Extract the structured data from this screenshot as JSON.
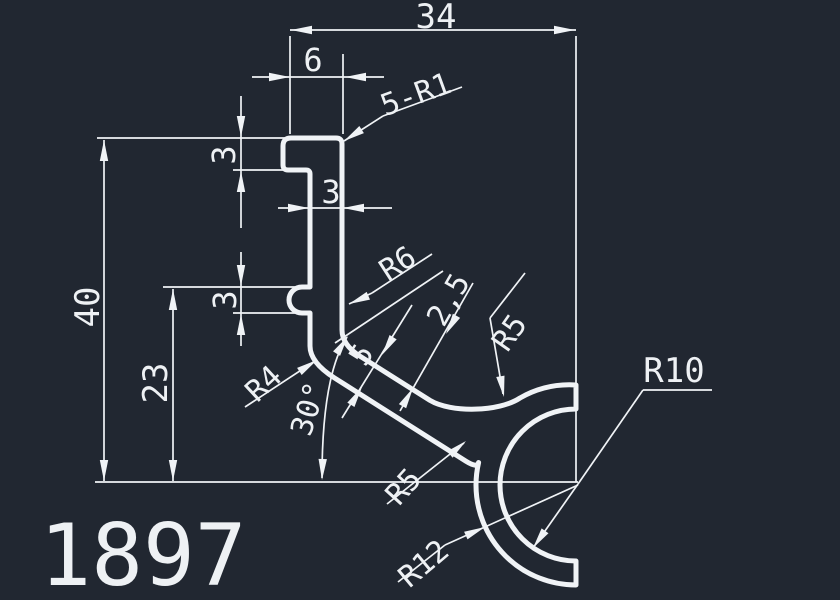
{
  "meta": {
    "type": "cad-technical-drawing",
    "part_number": "1897",
    "units_hint": "mm"
  },
  "colors": {
    "background": "#212731",
    "line": "#f0f3f6"
  },
  "dimensions_list": [
    {
      "label": "34",
      "kind": "linear-horizontal"
    },
    {
      "label": "6",
      "kind": "linear-horizontal"
    },
    {
      "label": "5-R1",
      "kind": "leader-radius-count"
    },
    {
      "label": "3",
      "kind": "linear-vertical-hook-top"
    },
    {
      "label": "3",
      "kind": "linear-wall-thickness"
    },
    {
      "label": "3",
      "kind": "linear-vertical-hook-lower"
    },
    {
      "label": "40",
      "kind": "linear-vertical"
    },
    {
      "label": "23",
      "kind": "linear-vertical"
    },
    {
      "label": "R6",
      "kind": "radius"
    },
    {
      "label": "2,5",
      "kind": "linear-thickness"
    },
    {
      "label": "R5",
      "kind": "radius-upper"
    },
    {
      "label": "R4",
      "kind": "radius"
    },
    {
      "label": "30°",
      "kind": "angular"
    },
    {
      "label": "5",
      "kind": "linear-thickness"
    },
    {
      "label": "R5",
      "kind": "radius-lower"
    },
    {
      "label": "R12",
      "kind": "radius"
    },
    {
      "label": "R10",
      "kind": "radius"
    }
  ],
  "drawing": {
    "width": 840,
    "height": 600,
    "profile_stroke_width": 5,
    "thin_stroke_width": 1.7,
    "profile_path": "M 291,138 L 336,138 Q 342,138 342,144 L 342,330 Q 342,344.8 360,356.2 L 430,400.4 C 451,413 499,412 520,398 A 100,100 0 0 1 576,385 L 576,409 A 76,76 0 0 0 500,485 A 76,76 0 0 0 576,561 L 576,585 A 100,100 0 0 1 476,485 A 100,100 0 0 1 478.6,462.5 Q 477.3,468.3 466,461.3 L 334.3,377.8 Q 310,362.4 310,346 L 310,313 L 302,313 A 13,13 0 0 1 302,287 L 310,287 L 310,174 Q 310,170 306,170 L 288,170 Q 283,170 283,165 L 283,146 Q 283,138 291,138 Z",
    "thin_lines": [
      [
        290,
        36,
        290,
        134
      ],
      [
        576,
        36,
        576,
        482
      ],
      [
        290,
        30,
        576,
        30
      ],
      [
        252,
        77,
        384,
        77
      ],
      [
        343,
        54,
        343,
        134
      ],
      [
        97,
        138,
        285,
        138
      ],
      [
        233,
        170,
        287,
        170
      ],
      [
        241,
        96,
        241,
        228
      ],
      [
        278,
        208,
        392,
        208
      ],
      [
        163,
        287,
        300,
        287
      ],
      [
        233,
        313,
        300,
        313
      ],
      [
        241,
        252,
        241,
        346
      ],
      [
        104,
        140,
        104,
        481
      ],
      [
        173,
        289,
        173,
        481
      ],
      [
        95,
        482,
        578,
        482
      ],
      [
        349,
        304,
        372,
        293
      ],
      [
        372,
        293,
        432,
        254
      ],
      [
        473,
        283,
        400,
        411
      ],
      [
        412,
        305,
        342,
        418
      ],
      [
        335,
        343,
        443,
        271
      ],
      [
        525,
        273,
        490,
        318
      ],
      [
        490,
        318,
        503,
        394
      ],
      [
        245,
        407,
        315,
        361
      ],
      [
        387,
        504,
        464,
        443
      ],
      [
        398,
        582,
        445,
        545
      ],
      [
        445,
        545,
        578,
        485
      ],
      [
        643,
        390,
        712,
        390
      ],
      [
        643,
        390,
        578,
        484
      ],
      [
        578,
        484,
        533,
        548
      ],
      [
        344,
        141,
        383,
        116
      ],
      [
        383,
        116,
        462,
        87
      ]
    ],
    "thin_paths": [
      "M 322,478 Q 322,376 347,337"
    ],
    "arrows": [
      [
        291,
        30,
        180
      ],
      [
        575,
        30,
        0
      ],
      [
        290,
        77,
        0
      ],
      [
        345,
        77,
        180
      ],
      [
        241,
        137,
        90
      ],
      [
        241,
        171,
        270
      ],
      [
        309,
        208,
        0
      ],
      [
        343,
        208,
        180
      ],
      [
        241,
        286,
        90
      ],
      [
        241,
        314,
        270
      ],
      [
        104,
        140,
        270
      ],
      [
        104,
        481,
        90
      ],
      [
        173,
        289,
        270
      ],
      [
        173,
        481,
        90
      ],
      [
        349,
        304,
        157
      ],
      [
        446,
        334,
        120
      ],
      [
        413,
        388,
        300
      ],
      [
        382,
        355,
        122
      ],
      [
        362,
        387,
        302
      ],
      [
        504,
        397,
        80
      ],
      [
        317,
        360,
        -33
      ],
      [
        322,
        480,
        92
      ],
      [
        348,
        336,
        -57
      ],
      [
        466,
        441,
        -40
      ],
      [
        485,
        527,
        -24
      ],
      [
        533,
        548,
        125
      ],
      [
        344,
        141,
        147
      ]
    ],
    "labels": [
      {
        "name": "dim-34",
        "text": "34",
        "x": 436,
        "y": 17,
        "rot": 0,
        "size": 34
      },
      {
        "name": "dim-6",
        "text": "6",
        "x": 313,
        "y": 60,
        "rot": 0,
        "size": 32
      },
      {
        "name": "dim-5-r1",
        "text": "5-R1",
        "x": 416,
        "y": 95,
        "rot": -20,
        "size": 30
      },
      {
        "name": "dim-3-hook-top",
        "text": "3",
        "x": 224,
        "y": 155,
        "rot": -90,
        "size": 32
      },
      {
        "name": "dim-3-wall",
        "text": "3",
        "x": 331,
        "y": 192,
        "rot": 0,
        "size": 32
      },
      {
        "name": "dim-3-hook-lower",
        "text": "3",
        "x": 225,
        "y": 300,
        "rot": -90,
        "size": 32
      },
      {
        "name": "dim-40",
        "text": "40",
        "x": 88,
        "y": 307,
        "rot": -90,
        "size": 34
      },
      {
        "name": "dim-23",
        "text": "23",
        "x": 156,
        "y": 383,
        "rot": -90,
        "size": 34
      },
      {
        "name": "radius-r6",
        "text": "R6",
        "x": 398,
        "y": 264,
        "rot": -33,
        "size": 30
      },
      {
        "name": "dim-2-5",
        "text": "2,5",
        "x": 449,
        "y": 300,
        "rot": -60,
        "size": 30
      },
      {
        "name": "radius-r5-upper",
        "text": "R5",
        "x": 510,
        "y": 333,
        "rot": -55,
        "size": 30
      },
      {
        "name": "radius-r4",
        "text": "R4",
        "x": 264,
        "y": 384,
        "rot": -43,
        "size": 30
      },
      {
        "name": "angle-30",
        "text": "30°",
        "x": 309,
        "y": 409,
        "rot": -73,
        "size": 30
      },
      {
        "name": "dim-5",
        "text": "5",
        "x": 362,
        "y": 355,
        "rot": -58,
        "size": 30
      },
      {
        "name": "radius-r5-lower",
        "text": "R5",
        "x": 404,
        "y": 487,
        "rot": -48,
        "size": 30
      },
      {
        "name": "radius-r12",
        "text": "R12",
        "x": 424,
        "y": 564,
        "rot": -40,
        "size": 30
      },
      {
        "name": "radius-r10",
        "text": "R10",
        "x": 674,
        "y": 371,
        "rot": 0,
        "size": 34
      },
      {
        "name": "part-number",
        "text": "1897",
        "x": 143,
        "y": 556,
        "rot": 0,
        "size": 86
      }
    ]
  }
}
